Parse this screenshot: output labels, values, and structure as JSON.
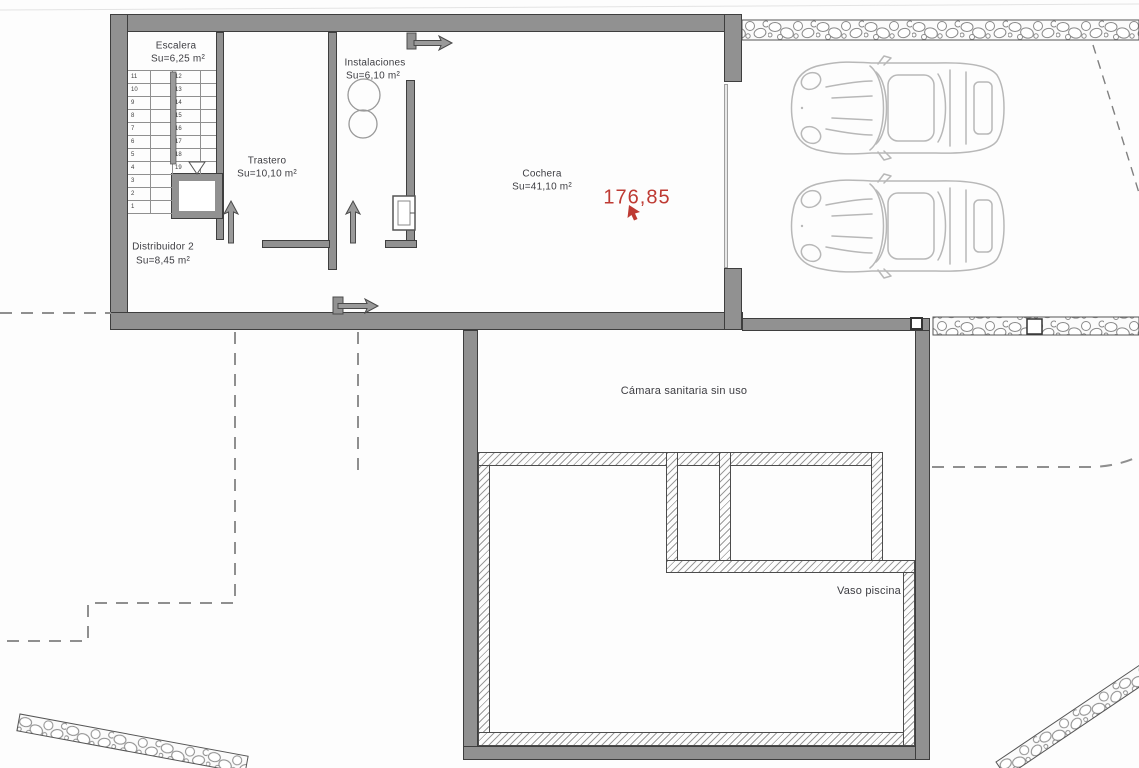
{
  "rooms": {
    "escalera": {
      "label": "Escalera",
      "area": "Su=6,25 m²"
    },
    "trastero": {
      "label": "Trastero",
      "area": "Su=10,10 m²"
    },
    "instalaciones": {
      "label": "Instalaciones",
      "area": "Su=6,10 m²"
    },
    "cochera": {
      "label": "Cochera",
      "area": "Su=41,10 m²"
    },
    "distribuidor": {
      "label": "Distribuidor 2",
      "area": "Su=8,45 m²"
    },
    "camara": {
      "label": "Cámara sanitaria sin uso"
    },
    "vaso": {
      "label": "Vaso piscina"
    }
  },
  "measurement": {
    "value": "176,85",
    "color": "#be3a33"
  },
  "stairs": {
    "left": [
      "11",
      "10",
      "9",
      "8",
      "7",
      "6",
      "5",
      "4",
      "3",
      "2",
      "1"
    ],
    "right": [
      "12",
      "13",
      "14",
      "15",
      "16",
      "17",
      "18",
      "19"
    ]
  },
  "colors": {
    "wall": "#919191",
    "wall_edge": "#3e3e3e",
    "hatch_line": "#9b9b9b",
    "drawing_line": "#9a9a9a",
    "dashed_boundary": "#8f8f8f",
    "car_outline": "#b8b8b8",
    "text": "#3d3d42"
  }
}
